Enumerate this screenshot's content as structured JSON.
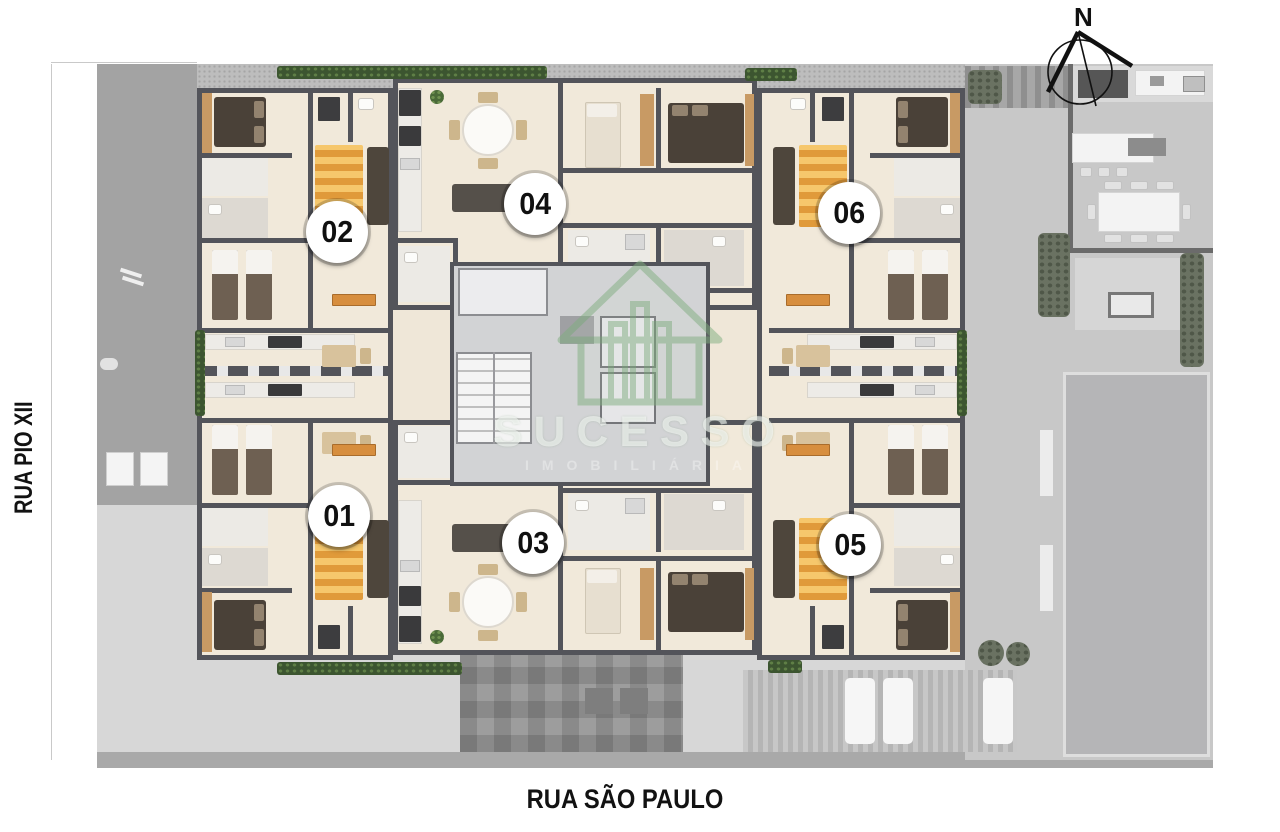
{
  "streets": {
    "left_label": "RUA PIO XII",
    "bottom_label": "RUA SÃO PAULO"
  },
  "compass": {
    "north_label": "N"
  },
  "watermark": {
    "brand": "SUCESSO",
    "tagline": "IMOBILIÁRIA"
  },
  "units": [
    {
      "label": "01"
    },
    {
      "label": "02"
    },
    {
      "label": "03"
    },
    {
      "label": "04"
    },
    {
      "label": "05"
    },
    {
      "label": "06"
    }
  ],
  "colors": {
    "wall": "#53545a",
    "unit_floor": "#f1e9da",
    "accent_orange": "#d78e3e",
    "hedge_green": "#3c5530",
    "logo_green": "#7fae7f",
    "ground_grey": "#bdbdbd"
  }
}
